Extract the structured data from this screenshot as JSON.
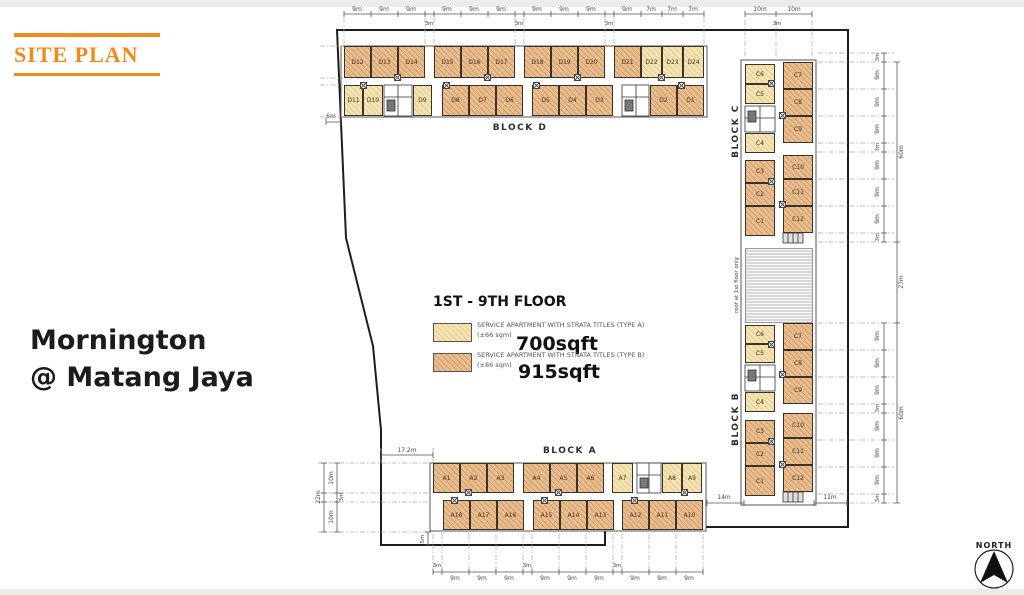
{
  "header": {
    "section_label": "SITE PLAN",
    "accent_color": "#F08A1D"
  },
  "project": {
    "name_line1": "Mornington",
    "name_line2": "@ Matang Jaya"
  },
  "legend": {
    "floor_range": "1ST - 9TH FLOOR",
    "type_a": {
      "desc": "SERVICE APARTMENT WITH STRATA TITLES (TYPE A)",
      "area_sqm": "(±66 sqm)",
      "area_sqft": "700sqft",
      "fill": "#f6e5b4"
    },
    "type_b": {
      "desc": "SERVICE APARTMENT WITH STRATA TITLES (TYPE B)",
      "area_sqm": "(±86 sqm)",
      "area_sqft": "915sqft",
      "fill": "#e9bd8e"
    }
  },
  "blocks": {
    "d": {
      "label": "BLOCK D",
      "top": [
        "D12",
        "D13",
        "D14",
        "D15",
        "D16",
        "D17",
        "D18",
        "D19",
        "D20",
        "D21",
        "D22",
        "D23",
        "D24"
      ],
      "bottom": [
        "D11",
        "D10",
        "D9",
        "D8",
        "D7",
        "D6",
        "D5",
        "D4",
        "D3",
        "D2",
        "D1"
      ]
    },
    "a": {
      "label": "BLOCK A",
      "top": [
        "A1",
        "A2",
        "A3",
        "A4",
        "A5",
        "A6",
        "A7",
        "A8",
        "A9"
      ],
      "bottom": [
        "A18",
        "A17",
        "A16",
        "A15",
        "A14",
        "A13",
        "A12",
        "A11",
        "A10"
      ]
    },
    "c": {
      "label": "BLOCK C",
      "left": [
        "C6",
        "C5",
        "C4",
        "C3",
        "C2",
        "C1"
      ],
      "right": [
        "C7",
        "C8",
        "C9",
        "C10",
        "C11",
        "C12"
      ]
    },
    "b": {
      "label": "BLOCK B",
      "left": [
        "C6",
        "C5",
        "C4",
        "C3",
        "C2",
        "C1"
      ],
      "right": [
        "C7",
        "C8",
        "C9",
        "C10",
        "C11",
        "C12"
      ]
    }
  },
  "roof_note": "roof at 1st floor only",
  "compass_label": "NORTH",
  "dims": {
    "top_d": [
      "9m",
      "9m",
      "9m",
      "3m",
      "9m",
      "9m",
      "9m",
      "3m",
      "9m",
      "9m",
      "9m",
      "3m",
      "9m",
      "7m",
      "7m",
      "7m"
    ],
    "top_c": [
      "10m",
      "3m",
      "10m"
    ],
    "right_c": [
      "3m",
      "9m",
      "9m",
      "9m",
      "3m",
      "9m",
      "9m",
      "9m",
      "3m"
    ],
    "right_b": [
      "9m",
      "9m",
      "9m",
      "3m",
      "9m",
      "9m",
      "9m",
      "3m"
    ],
    "right_outer": [
      "60m",
      "27m",
      "60m"
    ],
    "bottom": [
      "3m",
      "9m",
      "9m",
      "9m",
      "3m",
      "9m",
      "9m",
      "9m",
      "3m",
      "9m",
      "9m",
      "9m"
    ],
    "a_width": "17.2m",
    "a_total": "22m",
    "a_segs": [
      "10m",
      "3m",
      "10m"
    ],
    "a_5m": "5m",
    "d_6m": "6m",
    "b_14m": "14m",
    "b_11m": "11m"
  }
}
